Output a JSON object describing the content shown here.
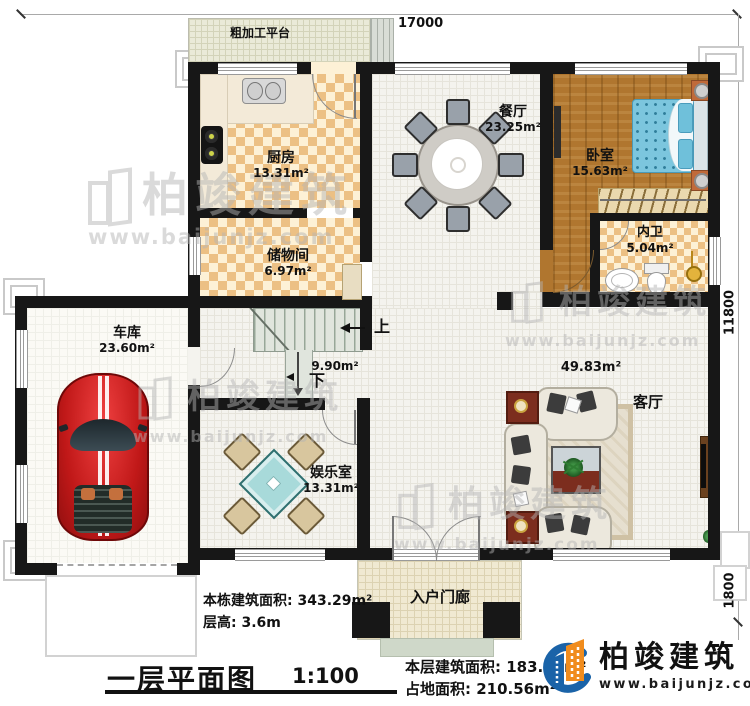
{
  "dims": {
    "top": "17000",
    "right_upper": "11800",
    "right_lower": "1800"
  },
  "rooms": {
    "platform": {
      "name": "粗加工平台"
    },
    "kitchen": {
      "name": "厨房",
      "area": "13.31m²"
    },
    "storage": {
      "name": "储物间",
      "area": "6.97m²"
    },
    "dining": {
      "name": "餐厅",
      "area": "23.25m²"
    },
    "bedroom": {
      "name": "卧室",
      "area": "15.63m²"
    },
    "bathroom": {
      "name": "内卫",
      "area": "5.04m²"
    },
    "garage": {
      "name": "车库",
      "area": "23.60m²"
    },
    "entertainment": {
      "name": "娱乐室",
      "area": "13.31m²"
    },
    "living": {
      "name": "客厅",
      "area": "49.83m²"
    },
    "stairs": {
      "area": "9.90m²",
      "up": "上",
      "down": "下"
    },
    "porch": {
      "name": "入户门廊"
    }
  },
  "info": {
    "building_area": "本栋建筑面积: 343.29m²",
    "floor_height": "层高: 3.6m",
    "floor_area": "本层建筑面积: 183.88m²",
    "footprint_area": "占地面积: 210.56m²"
  },
  "title": {
    "name": "一层平面图",
    "scale": "1:100"
  },
  "brand": {
    "name": "柏竣建筑",
    "url": "www.baijunjz.com"
  },
  "watermark": {
    "text": "柏竣建筑",
    "url": "www.baijunjz.com"
  },
  "colors": {
    "wall": "#171717",
    "checker": "#ecc084",
    "wood": "#b0762f",
    "bed": "#7cc6de",
    "mahjong_table": "#a8dada",
    "car": "#cf2027",
    "logo_blue": "#1a63a8",
    "logo_orange": "#f08c1e"
  }
}
